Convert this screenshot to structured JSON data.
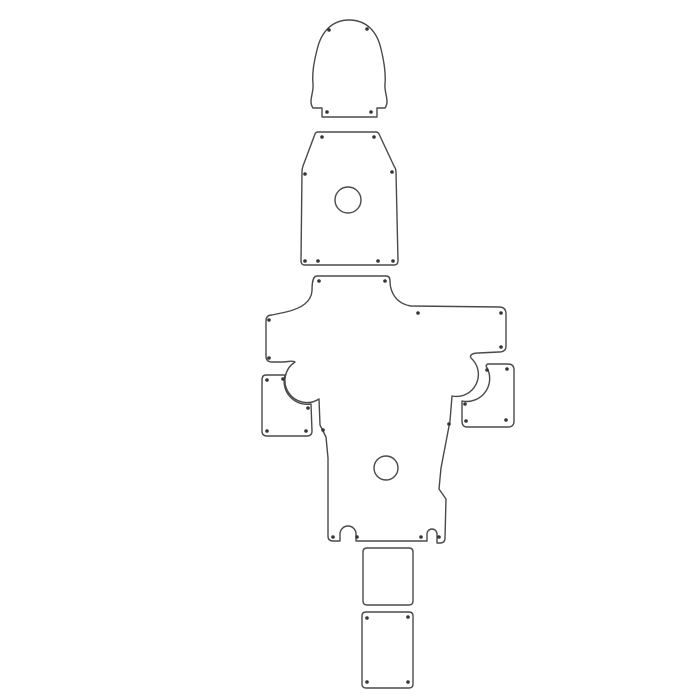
{
  "canvas": {
    "width": 700,
    "height": 700,
    "background_color": "#ffffff",
    "outline_color": "#4a4a4a",
    "outline_width": 1.4,
    "hole_color": "#353535",
    "hole_radius": 1.8
  },
  "pieces": [
    {
      "id": "head-bell-panel",
      "path": "M 313,108 C 308,101 314,93 313,84 C 312,72 314,62 317,50 C 321,32 332,20 349,20 C 366,20 377,31 381,49 C 384,61 386,72 385,84 C 384,93 390,101 385,108 L 377,108 L 377,117 L 322,117 L 322,108 Z",
      "holes": [
        [
          329,
          30
        ],
        [
          367,
          29
        ],
        [
          327,
          112
        ],
        [
          371,
          112
        ]
      ],
      "cutouts": []
    },
    {
      "id": "torso-trapezoid-panel",
      "path": "M 318,132 L 376,132 Q 378,132 379,134 L 394,166 Q 396,169 396,172 L 398,261 Q 398,265 394,265 L 305,265 Q 301,265 301,261 L 302,172 Q 302,169 303,166 L 315,134 Q 316,132 318,132 Z",
      "holes": [
        [
          322,
          137
        ],
        [
          374,
          137
        ],
        [
          305,
          174
        ],
        [
          392,
          172
        ],
        [
          305,
          261
        ],
        [
          318,
          261
        ],
        [
          378,
          261
        ],
        [
          393,
          261
        ]
      ],
      "cutouts": [
        {
          "cx": 348,
          "cy": 200,
          "r": 13
        }
      ]
    },
    {
      "id": "main-cross-body-panel",
      "path": "M 317,276 L 386,276 Q 390,276 390,281 C 390,293 397,304 411,306 L 499,307 Q 506,307 506,314 L 506,346 Q 506,352 499,352 L 478,353 C 473,353 469,355 471,358 A 22,22 0 0 1 452,396 L 450,421 L 441,468 L 439,489 L 446,499 L 445,538 Q 445,543 440,543 L 437,543 L 437,534 A 5,5 0 0 0 427,534 L 427,541 L 356,541 L 356,534 A 8,8 0 0 0 340,534 L 340,541 L 333,541 Q 328,541 328,536 L 328,458 L 326,437 L 320,425 L 319,399 A 22,22 0 0 1 295,362 C 292,360 288,362 283,362 L 272,362 Q 266,362 266,356 L 266,321 Q 266,315 272,315 L 286,312 C 299,309 311,303 312,291 C 312,282 313,276 317,276 Z",
      "holes": [
        [
          319,
          281
        ],
        [
          385,
          281
        ],
        [
          418,
          313
        ],
        [
          501,
          313
        ],
        [
          501,
          347
        ],
        [
          269,
          320
        ],
        [
          269,
          358
        ],
        [
          449,
          424
        ],
        [
          323,
          430
        ],
        [
          333,
          537
        ],
        [
          357,
          537
        ],
        [
          421,
          537
        ],
        [
          439,
          537
        ]
      ],
      "cutouts": [
        {
          "cx": 386,
          "cy": 468,
          "r": 12
        }
      ]
    },
    {
      "id": "left-side-panel",
      "path": "M 266,375 L 285,375 A 23,23 0 0 0 311,404 L 312,431 Q 312,436 307,436 L 267,436 Q 262,436 262,431 L 262,380 Q 262,375 266,375 Z",
      "holes": [
        [
          267,
          380
        ],
        [
          283,
          379
        ],
        [
          308,
          408
        ],
        [
          267,
          431
        ],
        [
          306,
          431
        ]
      ],
      "cutouts": []
    },
    {
      "id": "right-side-panel",
      "path": "M 488,364 L 508,364 Q 514,364 514,370 L 514,421 Q 514,427 508,427 L 467,427 Q 462,427 462,421 L 462,401 A 23,23 0 0 0 486,366 Q 487,364 488,364 Z",
      "holes": [
        [
          487,
          370
        ],
        [
          507,
          369
        ],
        [
          465,
          404
        ],
        [
          466,
          421
        ],
        [
          506,
          420
        ]
      ],
      "cutouts": []
    },
    {
      "id": "upper-small-rect-panel",
      "path": "M 367,548 L 409,548 Q 413,548 413,552 L 413,601 Q 413,605 409,605 L 367,605 Q 363,605 363,601 L 363,552 Q 363,548 367,548 Z",
      "holes": [],
      "cutouts": []
    },
    {
      "id": "lower-small-rect-panel",
      "path": "M 366,612 L 409,612 Q 413,612 413,616 L 413,684 Q 413,688 409,688 L 366,688 Q 362,688 362,684 L 362,616 Q 362,612 366,612 Z",
      "holes": [
        [
          367,
          618
        ],
        [
          408,
          617
        ],
        [
          367,
          682
        ],
        [
          408,
          682
        ]
      ],
      "cutouts": []
    }
  ]
}
